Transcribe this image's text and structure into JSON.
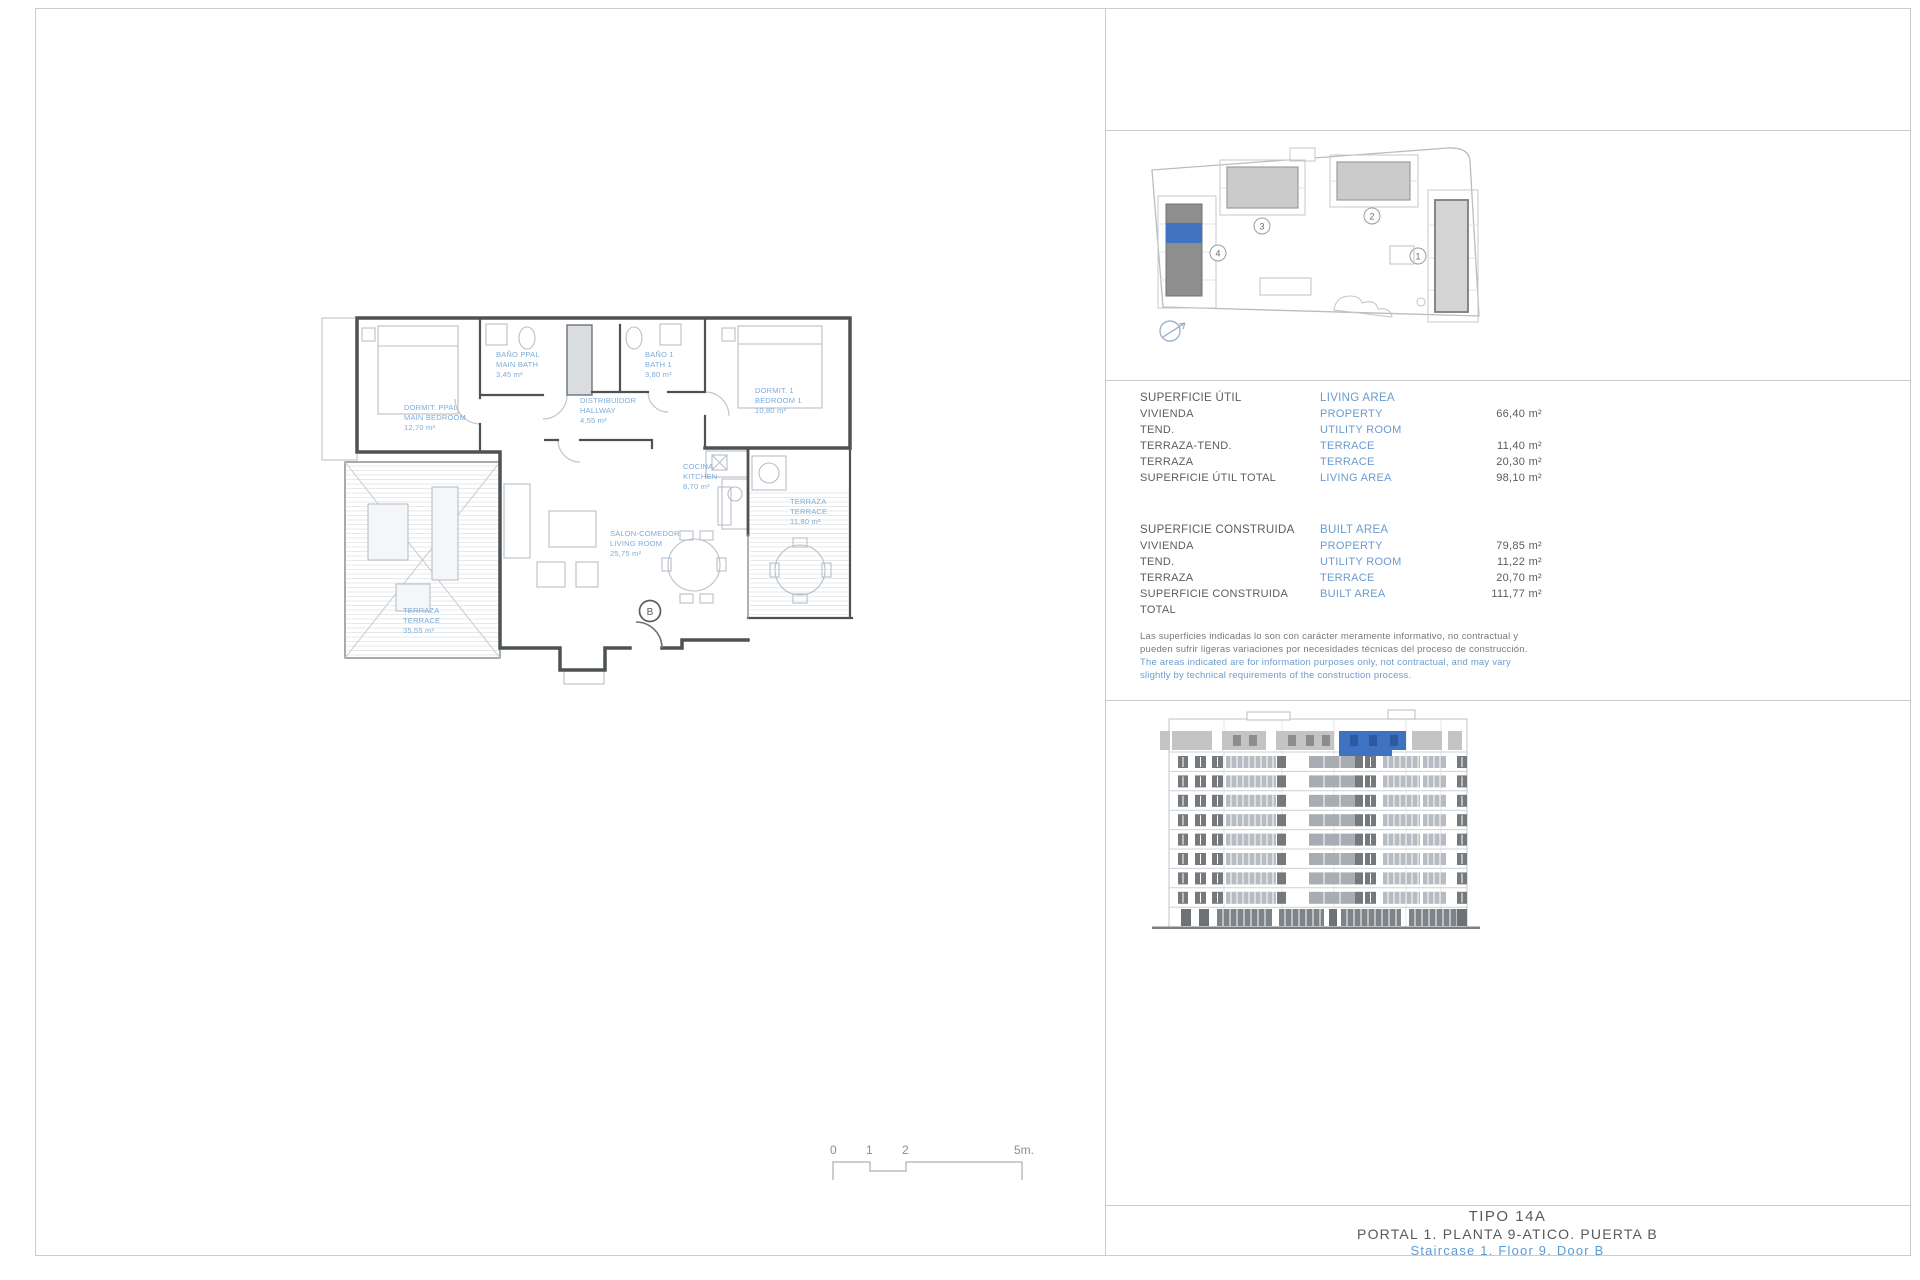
{
  "colors": {
    "accent_blue": "#3f72c0",
    "text_blue": "#6b9ace",
    "label_blue": "#7cabd9",
    "ink": "#58595b",
    "line_gray": "#c9cdd0"
  },
  "tables": {
    "util": {
      "title_es": "SUPERFICIE ÚTIL",
      "title_en": "LIVING AREA",
      "rows": [
        {
          "es": "VIVIENDA",
          "en": "PROPERTY",
          "val": "66,40 m²"
        },
        {
          "es": "TEND.",
          "en": "UTILITY ROOM",
          "val": ""
        },
        {
          "es": "TERRAZA-TEND.",
          "en": "TERRACE",
          "val": "11,40 m²"
        },
        {
          "es": "TERRAZA",
          "en": "TERRACE",
          "val": "20,30 m²"
        },
        {
          "es": "SUPERFICIE ÚTIL TOTAL",
          "en": "LIVING AREA",
          "val": "98,10 m²"
        }
      ]
    },
    "construida": {
      "title_es": "SUPERFICIE CONSTRUIDA",
      "title_en": "BUILT AREA",
      "rows": [
        {
          "es": "VIVIENDA",
          "en": "PROPERTY",
          "val": "79,85 m²"
        },
        {
          "es": "TEND.",
          "en": "UTILITY ROOM",
          "val": "11,22 m²"
        },
        {
          "es": "TERRAZA",
          "en": "TERRACE",
          "val": "20,70 m²"
        },
        {
          "es": "SUPERFICIE CONSTRUIDA TOTAL",
          "en": "BUILT AREA",
          "val": "111,77 m²"
        }
      ]
    }
  },
  "disclaimer": {
    "es": "Las superficies indicadas lo son con carácter meramente informativo, no contractual y pueden sufrir ligeras variaciones por necesidades técnicas del proceso de construcción.",
    "en": "The areas indicated are for information purposes only, not contractual, and may vary slightly by technical requirements of the construction process."
  },
  "title_block": {
    "line1": "TIPO 14A",
    "line2": "PORTAL 1. PLANTA 9-ATICO. PUERTA B",
    "line3": "Staircase 1. Floor 9. Door B"
  },
  "floor_plan": {
    "door_label": "B",
    "rooms": [
      {
        "es": "DORMIT. PPAL",
        "en": "MAIN BEDROOM",
        "area": "12,70 m²"
      },
      {
        "es": "BAÑO PPAL",
        "en": "MAIN BATH",
        "area": "3,45 m²"
      },
      {
        "es": "BAÑO 1",
        "en": "BATH 1",
        "area": "3,80 m²"
      },
      {
        "es": "DISTRIBUIDOR",
        "en": "HALLWAY",
        "area": "4,55 m²"
      },
      {
        "es": "DORMIT. 1",
        "en": "BEDROOM 1",
        "area": "10,80 m²"
      },
      {
        "es": "COCINA",
        "en": "KITCHEN",
        "area": "8,70 m²"
      },
      {
        "es": "SALON-COMEDOR",
        "en": "LIVING ROOM",
        "area": "25,75 m²"
      },
      {
        "es": "TERRAZA",
        "en": "TERRACE",
        "area": "11,80 m²"
      },
      {
        "es": "TERRAZA",
        "en": "TERRACE",
        "area": "35,55 m²"
      }
    ]
  },
  "scale_bar": {
    "labels": [
      "0",
      "1",
      "2",
      "5m."
    ]
  },
  "site_plan": {
    "labels": [
      "1",
      "2",
      "3",
      "4"
    ]
  }
}
